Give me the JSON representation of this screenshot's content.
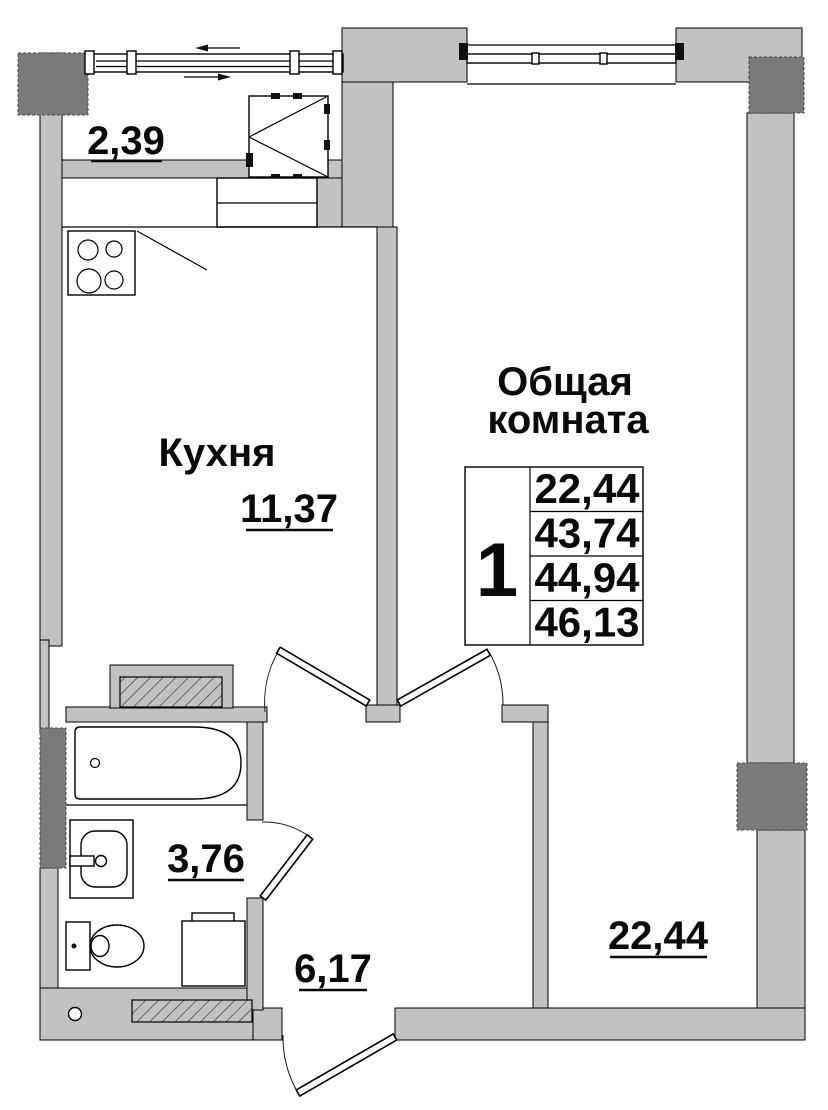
{
  "floor_plan": {
    "balcony": {
      "area_label": "2,39"
    },
    "kitchen": {
      "name": "Кухня",
      "area_label": "11,37"
    },
    "living_room": {
      "title_line1": "Общая",
      "title_line2": "комната",
      "area_label": "22,44"
    },
    "bathroom": {
      "area_label": "3,76"
    },
    "hallway": {
      "area_label": "6,17"
    },
    "apartment_table": {
      "rooms_count": "1",
      "areas": [
        "22,44",
        "43,74",
        "44,94",
        "46,13"
      ]
    },
    "colors": {
      "wall_fill": "#c2c2c2",
      "column_fill": "#7a7a7a",
      "line_color": "#000000",
      "floor_fill": "#ffffff"
    }
  }
}
